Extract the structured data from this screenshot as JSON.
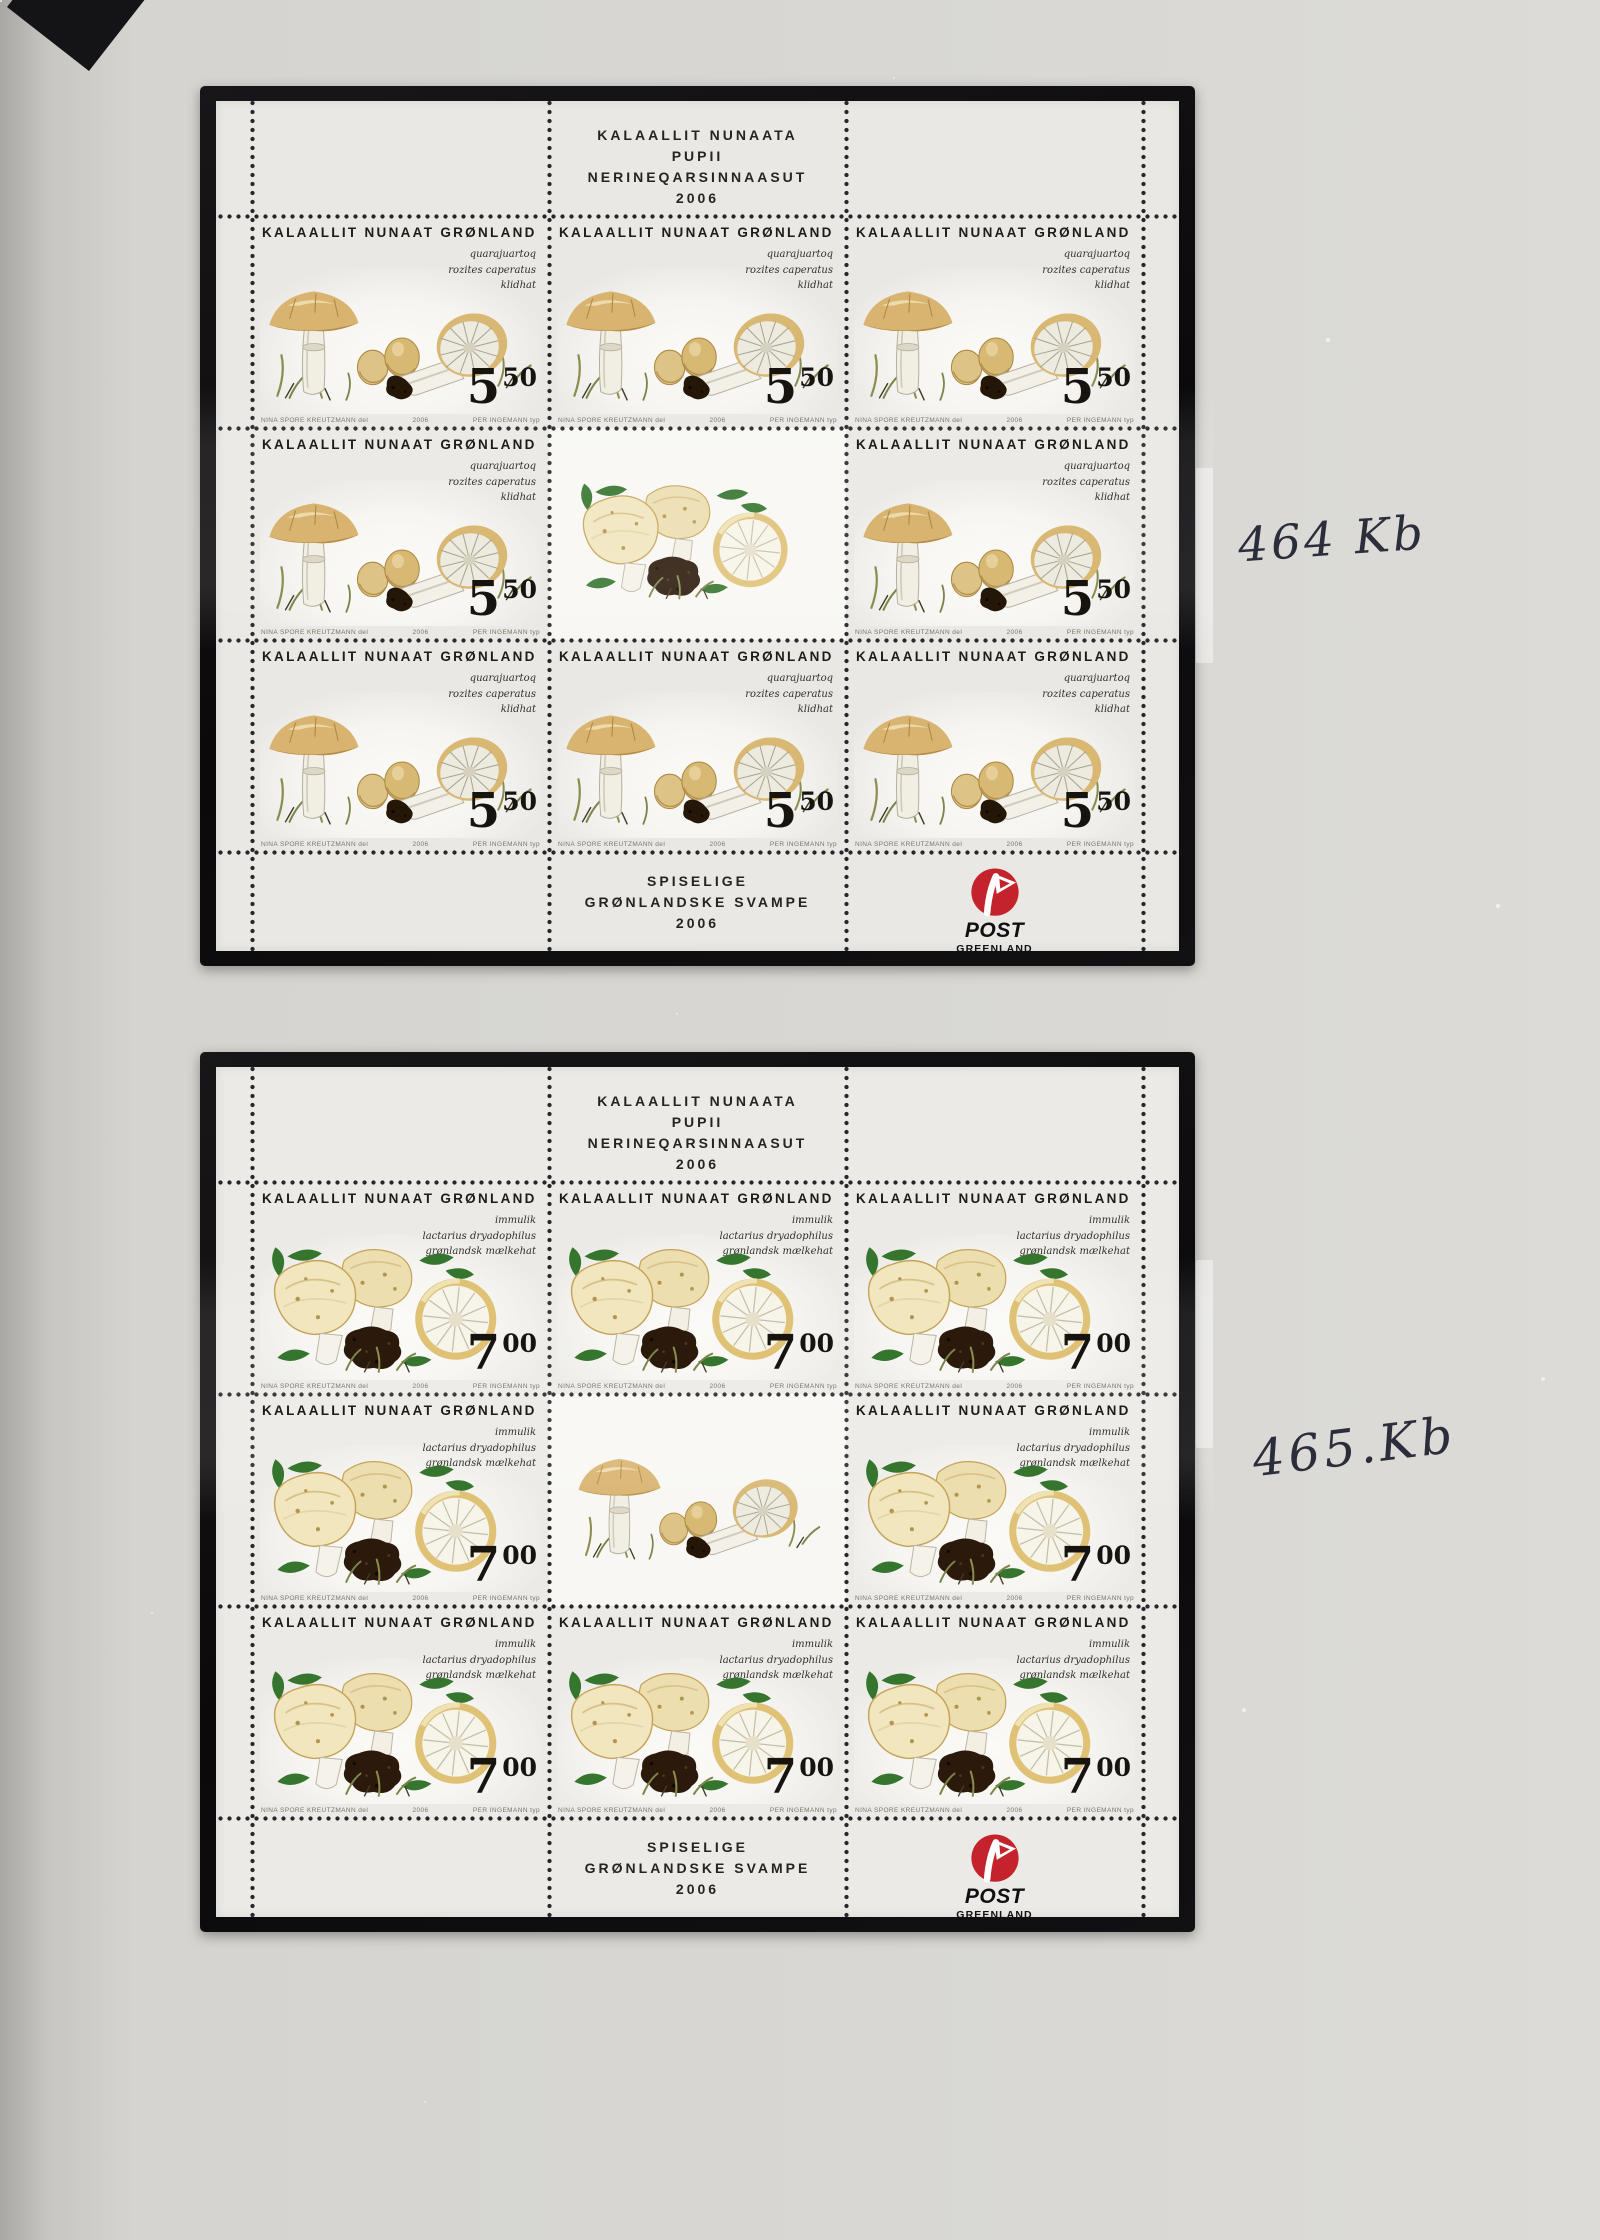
{
  "album": {
    "handwritten_note_top": "464 Kb",
    "handwritten_note_bottom": "465.Kb",
    "ink_color": "#2b2e3a",
    "mount_color": "#0d0d0f",
    "paper_color": "#e9e8e4"
  },
  "logo_color": "#c4232b",
  "sheets": [
    {
      "header": {
        "line1": "KALAALLIT NUNAATA",
        "line2": "PUPII",
        "line3": "NERINEQARSINNAASUT",
        "line4": "2006"
      },
      "footer": {
        "line1": "SPISELIGE",
        "line2": "GRØNLANDSKE SVAMPE",
        "line3": "2006"
      },
      "logo": {
        "name": "POST",
        "sub": "GREENLAND"
      },
      "stamp": {
        "country": "KALAALLIT NUNAAT GRØNLAND",
        "species": {
          "line1": "quarajuartoq",
          "line2": "rozites caperatus",
          "line3": "klidhat"
        },
        "value_main": "5",
        "value_sup": "50",
        "credits": {
          "left": "NINA SPORE KREUTZMANN del",
          "center": "2006",
          "right": "PER INGEMANN typ"
        }
      }
    },
    {
      "header": {
        "line1": "KALAALLIT NUNAATA",
        "line2": "PUPII",
        "line3": "NERINEQARSINNAASUT",
        "line4": "2006"
      },
      "footer": {
        "line1": "SPISELIGE",
        "line2": "GRØNLANDSKE SVAMPE",
        "line3": "2006"
      },
      "logo": {
        "name": "POST",
        "sub": "GREENLAND"
      },
      "stamp": {
        "country": "KALAALLIT NUNAAT GRØNLAND",
        "species": {
          "line1": "immulik",
          "line2": "lactarius dryadophilus",
          "line3": "grønlandsk mælkehat"
        },
        "value_main": "7",
        "value_sup": "00",
        "credits": {
          "left": "NINA SPORE KREUTZMANN del",
          "center": "2006",
          "right": "PER INGEMANN typ"
        }
      }
    }
  ]
}
